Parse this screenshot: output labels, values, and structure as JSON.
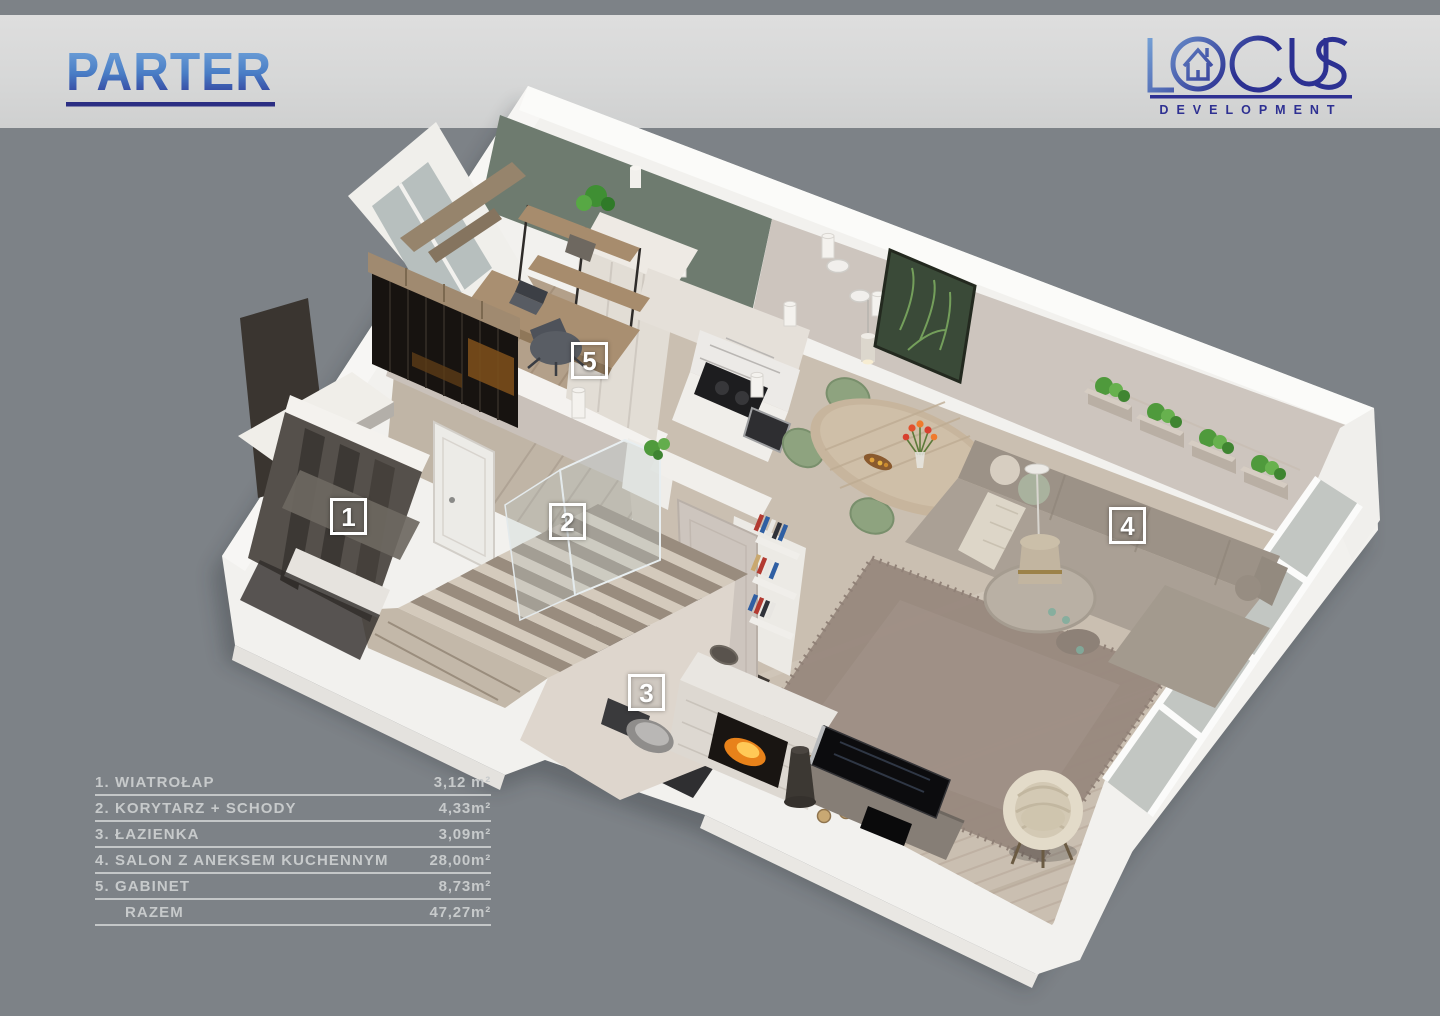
{
  "header": {
    "title": "PARTER"
  },
  "brand": {
    "logo_text": "LOCUS",
    "tagline": "DEVELOPMENT"
  },
  "floor_markers": [
    {
      "num": "1"
    },
    {
      "num": "2"
    },
    {
      "num": "3"
    },
    {
      "num": "4"
    },
    {
      "num": "5"
    }
  ],
  "legend": {
    "rows": [
      {
        "label": "1. WIATROŁAP",
        "area": "3,12 m²"
      },
      {
        "label": "2. KORYTARZ + SCHODY",
        "area": "4,33m²"
      },
      {
        "label": "3. ŁAZIENKA",
        "area": "3,09m²"
      },
      {
        "label": "4. SALON Z ANEKSEM KUCHENNYM",
        "area": "28,00m²"
      },
      {
        "label": "5. GABINET",
        "area": "8,73m²"
      },
      {
        "label": "RAZEM",
        "area": "47,27m²"
      }
    ]
  },
  "colors": {
    "background": "#7d8287",
    "header_band": "#d8d8d8",
    "title_gradient_top": "#71a3d9",
    "title_gradient_bottom": "#2c3192",
    "underline": "#2b2e83",
    "logo_indigo": "#2e3092",
    "legend_text": "#c7cacb",
    "marker_white": "#ffffff",
    "slab_white": "#f2f1ee",
    "wood_floor": "#cabfb1",
    "sage_wall": "#6e7b6f",
    "beige_wall": "#cdc5be",
    "bathroom_dark": "#2f2f31",
    "sofa_taupe": "#a49a8f",
    "chair_green": "#8ea37f",
    "fire_orange": "#f08c1e"
  }
}
